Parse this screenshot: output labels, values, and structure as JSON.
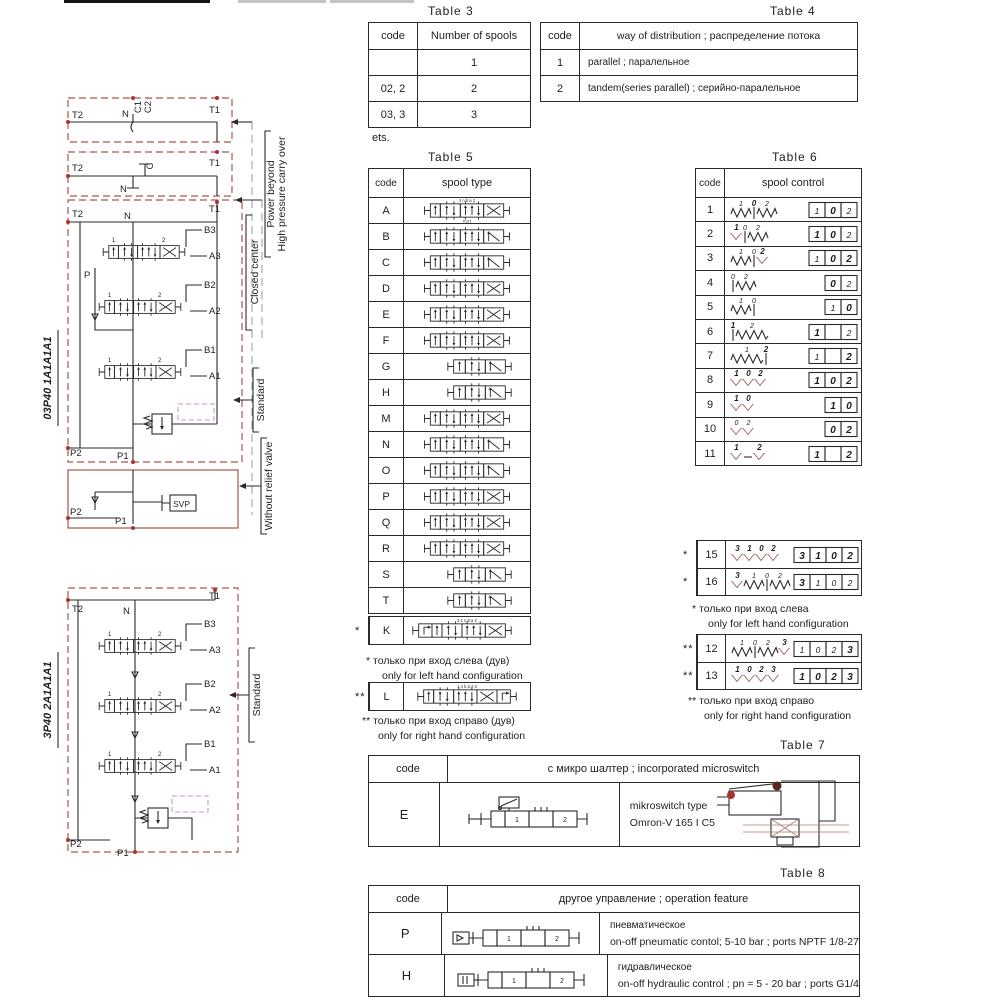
{
  "tables": {
    "t3": {
      "title": "Table 3",
      "col1": "code",
      "col2": "Number of spools",
      "rows": [
        [
          "",
          "1"
        ],
        [
          "02, 2",
          "2"
        ],
        [
          "03, 3",
          "3"
        ]
      ],
      "footnote": "ets."
    },
    "t4": {
      "title": "Table 4",
      "col1": "code",
      "col2": "way of distribution ; распределение потока",
      "rows": [
        [
          "1",
          "parallel ; паралельное"
        ],
        [
          "2",
          "tandem(series parallel) ; серийно-паралельное"
        ]
      ]
    },
    "t5": {
      "title": "Table 5",
      "col1": "code",
      "col2": "spool type",
      "rows": [
        {
          "code": "A",
          "sym": "3x",
          "top": "1    n b a    2",
          "bottom": "n p t"
        },
        {
          "code": "B",
          "sym": "3z"
        },
        {
          "code": "C",
          "sym": "3z"
        },
        {
          "code": "D",
          "sym": "3x"
        },
        {
          "code": "E",
          "sym": "3x"
        },
        {
          "code": "F",
          "sym": "3x"
        },
        {
          "code": "G",
          "sym": "2z"
        },
        {
          "code": "H",
          "sym": "2z"
        },
        {
          "code": "M",
          "sym": "3x"
        },
        {
          "code": "N",
          "sym": "3z"
        },
        {
          "code": "O",
          "sym": "3z"
        },
        {
          "code": "P",
          "sym": "3x"
        },
        {
          "code": "Q",
          "sym": "3x"
        },
        {
          "code": "R",
          "sym": "3x"
        },
        {
          "code": "S",
          "sym": "2z"
        },
        {
          "code": "T",
          "sym": "2z"
        }
      ],
      "k_row": {
        "mark": "*",
        "code": "K",
        "sym": "4xl",
        "top": "3    1    n b a    2"
      },
      "l_row": {
        "mark": "**",
        "code": "L",
        "sym": "4xr",
        "top": "1    n b a    2    3"
      },
      "note1_mark": "*",
      "note1_ru": "только при вход слева (дув)",
      "note1_en": "only for left hand configuration",
      "note2_mark": "**",
      "note2_ru": "только при вход справо (дув)",
      "note2_en": "only for right hand configuration"
    },
    "t6": {
      "title": "Table 6",
      "col1": "code",
      "col2": "spool control",
      "rows": [
        {
          "code": "1",
          "tokens": [
            "sp",
            "bar",
            "sp"
          ],
          "labels": [
            [
              "1",
              0
            ],
            [
              "0",
              1
            ],
            [
              "2",
              0
            ]
          ],
          "boxes": [
            [
              "1",
              0
            ],
            [
              "0",
              1
            ],
            [
              "2",
              0
            ]
          ]
        },
        {
          "code": "2",
          "tokens": [
            "det",
            "bar",
            "sp"
          ],
          "labels": [
            [
              "1",
              1
            ],
            [
              "0",
              0
            ],
            [
              "2",
              0
            ]
          ],
          "boxes": [
            [
              "1",
              1
            ],
            [
              "0",
              1
            ],
            [
              "2",
              0
            ]
          ]
        },
        {
          "code": "3",
          "tokens": [
            "sp",
            "bar",
            "det"
          ],
          "labels": [
            [
              "1",
              0
            ],
            [
              "0",
              0
            ],
            [
              "2",
              1
            ]
          ],
          "boxes": [
            [
              "1",
              0
            ],
            [
              "0",
              1
            ],
            [
              "2",
              1
            ]
          ]
        },
        {
          "code": "4",
          "tokens": [
            "bar",
            "sp"
          ],
          "labels": [
            [
              "0",
              0
            ],
            [
              "2",
              0
            ]
          ],
          "boxes": [
            [
              "0",
              1
            ],
            [
              "2",
              0
            ]
          ]
        },
        {
          "code": "5",
          "tokens": [
            "sp",
            "bar"
          ],
          "labels": [
            [
              "1",
              0
            ],
            [
              "0",
              0
            ]
          ],
          "boxes": [
            [
              "1",
              0
            ],
            [
              "0",
              1
            ]
          ]
        },
        {
          "code": "6",
          "tokens": [
            "bar",
            "spL"
          ],
          "labels": [
            [
              "1",
              1
            ],
            [
              "2",
              0
            ]
          ],
          "boxes": [
            [
              "1",
              1
            ],
            [
              "",
              0
            ],
            [
              "2",
              0
            ]
          ]
        },
        {
          "code": "7",
          "tokens": [
            "spL",
            "bar"
          ],
          "labels": [
            [
              "1",
              0
            ],
            [
              "2",
              1
            ]
          ],
          "boxes": [
            [
              "1",
              0
            ],
            [
              "",
              0
            ],
            [
              "2",
              1
            ]
          ]
        },
        {
          "code": "8",
          "tokens": [
            "det",
            "det",
            "det"
          ],
          "labels": [
            [
              "1",
              1
            ],
            [
              "0",
              1
            ],
            [
              "2",
              1
            ]
          ],
          "boxes": [
            [
              "1",
              1
            ],
            [
              "0",
              1
            ],
            [
              "2",
              1
            ]
          ]
        },
        {
          "code": "9",
          "tokens": [
            "det",
            "det"
          ],
          "labels": [
            [
              "1",
              1
            ],
            [
              "0",
              1
            ]
          ],
          "boxes": [
            [
              "1",
              1
            ],
            [
              "0",
              1
            ]
          ]
        },
        {
          "code": "10",
          "tokens": [
            "det",
            "det"
          ],
          "labels": [
            [
              "0",
              0
            ],
            [
              "2",
              0
            ]
          ],
          "boxes": [
            [
              "0",
              1
            ],
            [
              "2",
              1
            ]
          ]
        },
        {
          "code": "11",
          "tokens": [
            "det",
            "dash",
            "det"
          ],
          "labels": [
            [
              "1",
              1
            ],
            [
              "",
              0
            ],
            [
              "2",
              1
            ]
          ],
          "boxes": [
            [
              "1",
              1
            ],
            [
              "",
              0
            ],
            [
              "2",
              1
            ]
          ]
        }
      ],
      "extraA": [
        {
          "mark": "*",
          "code": "15",
          "tokens": [
            "det",
            "det",
            "det",
            "det"
          ],
          "labels": [
            [
              "3",
              1
            ],
            [
              "1",
              1
            ],
            [
              "0",
              1
            ],
            [
              "2",
              1
            ]
          ],
          "boxes": [
            [
              "3",
              1
            ],
            [
              "1",
              1
            ],
            [
              "0",
              1
            ],
            [
              "2",
              1
            ]
          ]
        },
        {
          "mark": "*",
          "code": "16",
          "tokens": [
            "det",
            "sp",
            "bar",
            "sp"
          ],
          "labels": [
            [
              "3",
              1
            ],
            [
              "1",
              0
            ],
            [
              "0",
              0
            ],
            [
              "2",
              0
            ]
          ],
          "boxes": [
            [
              "3",
              1
            ],
            [
              "1",
              0
            ],
            [
              "0",
              0
            ],
            [
              "2",
              0
            ]
          ]
        }
      ],
      "noteA_mark": "*",
      "noteA_ru": "только при вход слева",
      "noteA_en": "only for left hand configuration",
      "extraB": [
        {
          "mark": "**",
          "code": "12",
          "tokens": [
            "sp",
            "bar",
            "sp",
            "det"
          ],
          "labels": [
            [
              "1",
              0
            ],
            [
              "0",
              0
            ],
            [
              "2",
              0
            ],
            [
              "3",
              1
            ]
          ],
          "boxes": [
            [
              "1",
              0
            ],
            [
              "0",
              0
            ],
            [
              "2",
              0
            ],
            [
              "3",
              1
            ]
          ]
        },
        {
          "mark": "**",
          "code": "13",
          "tokens": [
            "det",
            "det",
            "det",
            "det"
          ],
          "labels": [
            [
              "1",
              1
            ],
            [
              "0",
              1
            ],
            [
              "2",
              1
            ],
            [
              "3",
              1
            ]
          ],
          "boxes": [
            [
              "1",
              1
            ],
            [
              "0",
              1
            ],
            [
              "2",
              1
            ],
            [
              "3",
              1
            ]
          ]
        }
      ],
      "noteB_mark": "**",
      "noteB_ru": "только при вход справо",
      "noteB_en": "only for right hand configuration"
    },
    "t7": {
      "title": "Table 7",
      "col1": "code",
      "col2": "с микро шалтер ; incorporated microswitch",
      "row_code": "E",
      "line1": "mikroswitch type",
      "line2": "Omron-V 165 I C5",
      "sym_digits": [
        "1",
        "2"
      ]
    },
    "t8": {
      "title": "Table 8",
      "col1": "code",
      "col2": "другое управление ; operation feature",
      "sym_digits": [
        "1",
        "2"
      ],
      "rows": [
        {
          "code": "P",
          "ru": "пневматическое",
          "en": "on-off pneumatic contol; 5-10 bar ; ports NPTF 1/8-27"
        },
        {
          "code": "H",
          "ru": "гидравлическое",
          "en": "on-off hydraulic control ; pn = 5 - 20 bar ; ports G1/4"
        }
      ]
    }
  },
  "diag1": {
    "title": "03P40 1A1A1A1",
    "valve_labels": [
      "1",
      "2"
    ],
    "pb": {
      "t2": "T2",
      "n": "N",
      "c1": "C1",
      "c2": "C2",
      "t1": "T1"
    },
    "side_pb1": "Power beyond",
    "side_pb2": "High pressure carry over",
    "cc": {
      "t2": "T2",
      "c": "C",
      "n": "N",
      "t1": "T1"
    },
    "side_cc": "Closed center",
    "main": {
      "t2": "T2",
      "n": "N",
      "t1": "T1",
      "b3": "B3",
      "a3": "A3",
      "p": "P",
      "b2": "B2",
      "a2": "A2",
      "b1": "B1",
      "a1": "A1",
      "p2": "P2",
      "p1": "P1"
    },
    "side_std": "Standard",
    "wr": {
      "p2": "P2",
      "p1": "P1",
      "svp": "SVP"
    },
    "side_wr": "Without relief valve"
  },
  "diag2": {
    "title": "3P40 2A1A1A1",
    "valve_labels": [
      "1",
      "2"
    ],
    "main": {
      "t2": "T2",
      "t1": "T1",
      "n": "N",
      "b3": "B3",
      "a3": "A3",
      "b2": "B2",
      "a2": "A2",
      "b1": "B1",
      "a1": "A1",
      "p2": "P2",
      "p1": "P1"
    },
    "side_std": "Standard"
  }
}
